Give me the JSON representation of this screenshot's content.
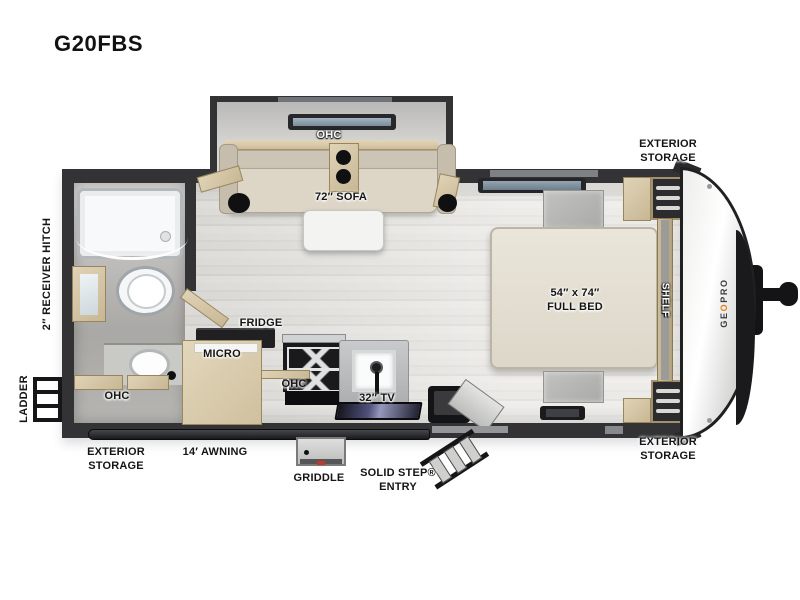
{
  "title": "G20FBS",
  "logo": {
    "part1": "GE",
    "accent": "O",
    "part2": "PRO"
  },
  "labels": {
    "front_top_storage": {
      "line1": "EXTERIOR",
      "line2": "STORAGE"
    },
    "front_bottom_storage": {
      "line1": "EXTERIOR",
      "line2": "STORAGE"
    },
    "rear_storage": {
      "line1": "EXTERIOR",
      "line2": "STORAGE"
    },
    "receiver_hitch": "2″ RECEIVER HITCH",
    "ladder": "LADDER",
    "sofa_ohc": "OHC",
    "sofa": "72″ SOFA",
    "bed": {
      "line1": "54″ x 74″",
      "line2": "FULL BED"
    },
    "shelf": "SHELF",
    "bath_ohc": "OHC",
    "fridge": "FRIDGE",
    "micro": "MICRO",
    "kitchen_ohc": "OHC",
    "tv": "32″ TV",
    "awning": "14′ AWNING",
    "griddle": "GRIDDLE",
    "entry": {
      "line1": "SOLID STEP®",
      "line2": "ENTRY"
    }
  },
  "colors": {
    "wall": "#333336",
    "wood": "#d2c3a1",
    "floor": "#e0deda",
    "upholstery": "#ddd6c7",
    "label_text": "#151515",
    "logo_accent_orange": "#e07b1a",
    "nose_white": "#f4f4f3"
  }
}
